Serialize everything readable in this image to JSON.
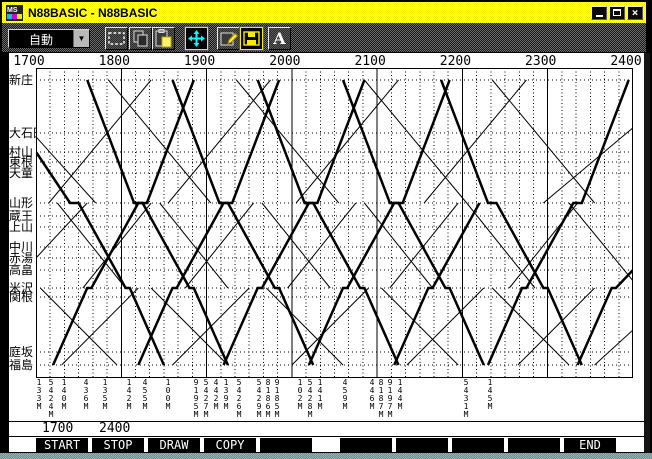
{
  "window": {
    "title": "N88BASIC - N88BASIC"
  },
  "toolbar": {
    "mode_value": "自動",
    "buttons": [
      {
        "name": "selection",
        "active": false
      },
      {
        "name": "copy",
        "active": false
      },
      {
        "name": "paste",
        "active": false
      },
      {
        "name": "fit-window",
        "active": true
      },
      {
        "name": "properties",
        "active": false
      },
      {
        "name": "save",
        "active": true
      },
      {
        "name": "font",
        "active": false
      }
    ]
  },
  "status": {
    "start_time": "1700",
    "stop_time": "2400"
  },
  "function_keys": [
    "START",
    "STOP",
    "DRAW",
    "COPY",
    "",
    "",
    "",
    "",
    "",
    "END"
  ],
  "chart_data": {
    "type": "line",
    "title": "train time-distance diagram (Ou line, Shinjo - Fukushima)",
    "x_axis": {
      "labels": [
        "1700",
        "1800",
        "1900",
        "2000",
        "2100",
        "2200",
        "2300",
        "2400"
      ],
      "start_hour": 17,
      "end_hour": 24,
      "minor_tick_minutes": 10
    },
    "stations": [
      {
        "name": "新庄",
        "y": 80
      },
      {
        "name": "大石田",
        "y": 133
      },
      {
        "name": "村山",
        "y": 152
      },
      {
        "name": "東根",
        "y": 162
      },
      {
        "name": "天童",
        "y": 173
      },
      {
        "name": "山形",
        "y": 203
      },
      {
        "name": "蔵王",
        "y": 216
      },
      {
        "name": "上山",
        "y": 227
      },
      {
        "name": "中川",
        "y": 247
      },
      {
        "name": "赤湯",
        "y": 258
      },
      {
        "name": "高畠",
        "y": 270
      },
      {
        "name": "米沢",
        "y": 288
      },
      {
        "name": "関根",
        "y": 297
      },
      {
        "name": "庭坂",
        "y": 352
      },
      {
        "name": "福島",
        "y": 365
      }
    ],
    "train_numbers": [
      {
        "x": 39,
        "no": "133M"
      },
      {
        "x": 51,
        "no": "5424M"
      },
      {
        "x": 64,
        "no": "140M"
      },
      {
        "x": 86,
        "no": "436M"
      },
      {
        "x": 105,
        "no": "135M"
      },
      {
        "x": 129,
        "no": "142M"
      },
      {
        "x": 145,
        "no": "455M"
      },
      {
        "x": 168,
        "no": "100M"
      },
      {
        "x": 196,
        "no": "9195M"
      },
      {
        "x": 206,
        "no": "5427M"
      },
      {
        "x": 216,
        "no": "442M"
      },
      {
        "x": 226,
        "no": "139M"
      },
      {
        "x": 239,
        "no": "5426M"
      },
      {
        "x": 259,
        "no": "5429M"
      },
      {
        "x": 268,
        "no": "8186M"
      },
      {
        "x": 277,
        "no": "9185M"
      },
      {
        "x": 300,
        "no": "102M"
      },
      {
        "x": 310,
        "no": "5428M"
      },
      {
        "x": 320,
        "no": "141M"
      },
      {
        "x": 345,
        "no": "459M"
      },
      {
        "x": 372,
        "no": "446M"
      },
      {
        "x": 381,
        "no": "8187M"
      },
      {
        "x": 390,
        "no": "9197M"
      },
      {
        "x": 400,
        "no": "144M"
      },
      {
        "x": 466,
        "no": "5431M"
      },
      {
        "x": 490,
        "no": "145M"
      }
    ],
    "trains": [
      {
        "w": 2.5,
        "p": [
          [
            17.0,
            2
          ],
          [
            17.4,
            5
          ],
          [
            17.5,
            5
          ],
          [
            18.05,
            11
          ],
          [
            18.1,
            11
          ],
          [
            18.5,
            14
          ]
        ]
      },
      {
        "w": 2.5,
        "p": [
          [
            17.6,
            0
          ],
          [
            18.15,
            5
          ],
          [
            18.25,
            5
          ],
          [
            18.8,
            11
          ],
          [
            18.85,
            11
          ],
          [
            19.25,
            14
          ]
        ]
      },
      {
        "w": 2.5,
        "p": [
          [
            18.6,
            0
          ],
          [
            19.15,
            5
          ],
          [
            19.25,
            5
          ],
          [
            19.8,
            11
          ],
          [
            19.85,
            11
          ],
          [
            20.25,
            14
          ]
        ]
      },
      {
        "w": 2.5,
        "p": [
          [
            19.6,
            0
          ],
          [
            20.15,
            5
          ],
          [
            20.25,
            5
          ],
          [
            20.8,
            11
          ],
          [
            20.85,
            11
          ],
          [
            21.25,
            14
          ]
        ]
      },
      {
        "w": 2.5,
        "p": [
          [
            20.6,
            0
          ],
          [
            21.15,
            5
          ],
          [
            21.25,
            5
          ],
          [
            21.8,
            11
          ],
          [
            21.85,
            11
          ],
          [
            22.25,
            14
          ]
        ]
      },
      {
        "w": 2.5,
        "p": [
          [
            21.75,
            0
          ],
          [
            22.3,
            5
          ],
          [
            22.4,
            5
          ],
          [
            22.95,
            11
          ],
          [
            23.0,
            11
          ],
          [
            23.4,
            14
          ]
        ]
      },
      {
        "w": 2.5,
        "p": [
          [
            17.2,
            14
          ],
          [
            17.6,
            11
          ],
          [
            17.65,
            11
          ],
          [
            18.2,
            5
          ],
          [
            18.3,
            5
          ],
          [
            18.85,
            0
          ]
        ]
      },
      {
        "w": 2.5,
        "p": [
          [
            18.2,
            14
          ],
          [
            18.6,
            11
          ],
          [
            18.65,
            11
          ],
          [
            19.2,
            5
          ],
          [
            19.3,
            5
          ],
          [
            19.85,
            0
          ]
        ]
      },
      {
        "w": 2.5,
        "p": [
          [
            19.2,
            14
          ],
          [
            19.6,
            11
          ],
          [
            19.65,
            11
          ],
          [
            20.2,
            5
          ],
          [
            20.3,
            5
          ],
          [
            20.85,
            0
          ]
        ]
      },
      {
        "w": 2.5,
        "p": [
          [
            20.2,
            14
          ],
          [
            20.6,
            11
          ],
          [
            20.65,
            11
          ],
          [
            21.2,
            5
          ],
          [
            21.3,
            5
          ],
          [
            21.85,
            0
          ]
        ]
      },
      {
        "w": 2.5,
        "p": [
          [
            21.2,
            14
          ],
          [
            21.6,
            11
          ],
          [
            21.65,
            11
          ],
          [
            22.2,
            5
          ]
        ]
      },
      {
        "w": 2.5,
        "p": [
          [
            22.3,
            14
          ],
          [
            22.7,
            11
          ],
          [
            22.75,
            11
          ],
          [
            23.3,
            5
          ],
          [
            23.4,
            5
          ],
          [
            23.95,
            0
          ]
        ]
      },
      {
        "w": 2.5,
        "p": [
          [
            23.35,
            14
          ],
          [
            23.75,
            11
          ],
          [
            23.8,
            11
          ],
          [
            24.0,
            10
          ]
        ]
      },
      {
        "w": 1,
        "p": [
          [
            17.05,
            11
          ],
          [
            17.95,
            14
          ]
        ]
      },
      {
        "w": 1,
        "p": [
          [
            17.3,
            14
          ],
          [
            18.2,
            11
          ]
        ]
      },
      {
        "w": 1,
        "p": [
          [
            18.35,
            11
          ],
          [
            19.25,
            14
          ]
        ]
      },
      {
        "w": 1,
        "p": [
          [
            18.6,
            14
          ],
          [
            19.5,
            11
          ]
        ]
      },
      {
        "w": 1,
        "p": [
          [
            19.7,
            11
          ],
          [
            20.6,
            14
          ]
        ]
      },
      {
        "w": 1,
        "p": [
          [
            20.0,
            14
          ],
          [
            20.9,
            11
          ]
        ]
      },
      {
        "w": 1,
        "p": [
          [
            21.05,
            11
          ],
          [
            21.95,
            14
          ]
        ]
      },
      {
        "w": 1,
        "p": [
          [
            21.35,
            14
          ],
          [
            22.25,
            11
          ]
        ]
      },
      {
        "w": 1,
        "p": [
          [
            22.35,
            11
          ],
          [
            23.25,
            14
          ]
        ]
      },
      {
        "w": 1,
        "p": [
          [
            22.65,
            14
          ],
          [
            23.55,
            11
          ]
        ]
      },
      {
        "w": 1,
        "p": [
          [
            23.55,
            14
          ],
          [
            24.0,
            12.6
          ]
        ]
      },
      {
        "w": 1,
        "p": [
          [
            17.0,
            9
          ],
          [
            17.6,
            5
          ]
        ]
      },
      {
        "w": 1,
        "p": [
          [
            17.55,
            11
          ],
          [
            18.35,
            5
          ]
        ]
      },
      {
        "w": 1,
        "p": [
          [
            18.75,
            11
          ],
          [
            19.55,
            5
          ]
        ]
      },
      {
        "w": 1,
        "p": [
          [
            19.95,
            11
          ],
          [
            20.75,
            5
          ]
        ]
      },
      {
        "w": 1,
        "p": [
          [
            21.15,
            11
          ],
          [
            21.95,
            5
          ]
        ]
      },
      {
        "w": 1,
        "p": [
          [
            22.55,
            11
          ],
          [
            23.35,
            5
          ]
        ]
      },
      {
        "w": 1,
        "p": [
          [
            17.25,
            5
          ],
          [
            18.05,
            11
          ]
        ]
      },
      {
        "w": 1,
        "p": [
          [
            18.45,
            5
          ],
          [
            19.25,
            11
          ]
        ]
      },
      {
        "w": 1,
        "p": [
          [
            19.65,
            5
          ],
          [
            20.45,
            11
          ]
        ]
      },
      {
        "w": 1,
        "p": [
          [
            20.85,
            5
          ],
          [
            21.65,
            11
          ]
        ]
      },
      {
        "w": 1,
        "p": [
          [
            22.05,
            5
          ],
          [
            22.85,
            11
          ]
        ]
      },
      {
        "w": 1,
        "p": [
          [
            23.25,
            5
          ],
          [
            24.0,
            10.6
          ]
        ]
      },
      {
        "w": 1,
        "p": [
          [
            17.15,
            5
          ],
          [
            18.35,
            0
          ]
        ]
      },
      {
        "w": 1,
        "p": [
          [
            18.55,
            5
          ],
          [
            19.75,
            0
          ]
        ]
      },
      {
        "w": 1,
        "p": [
          [
            20.05,
            5
          ],
          [
            21.25,
            0
          ]
        ]
      },
      {
        "w": 1,
        "p": [
          [
            21.55,
            5
          ],
          [
            22.75,
            0
          ]
        ]
      },
      {
        "w": 1,
        "p": [
          [
            22.95,
            5
          ],
          [
            24.0,
            0.9
          ]
        ]
      },
      {
        "w": 1,
        "p": [
          [
            17.0,
            1.2
          ],
          [
            17.7,
            5
          ]
        ]
      },
      {
        "w": 1,
        "p": [
          [
            17.85,
            0
          ],
          [
            19.05,
            5
          ]
        ]
      },
      {
        "w": 1,
        "p": [
          [
            19.35,
            0
          ],
          [
            20.55,
            5
          ]
        ]
      },
      {
        "w": 1,
        "p": [
          [
            20.85,
            0
          ],
          [
            22.05,
            5
          ]
        ]
      },
      {
        "w": 1,
        "p": [
          [
            22.35,
            0
          ],
          [
            23.55,
            5
          ]
        ]
      }
    ]
  }
}
